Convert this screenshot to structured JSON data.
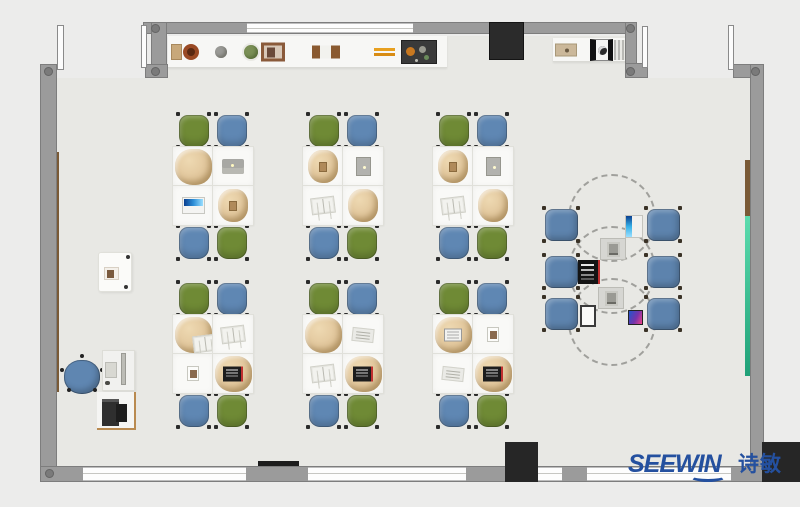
{
  "brand": {
    "name": "SEEWIN",
    "cjk": "诗敏",
    "color": "#24509f"
  },
  "palette": {
    "outside": "#ececeb",
    "floor": "#e8e8e4",
    "wall": "#9b9b9b",
    "chair_green": "#6f8a35",
    "chair_blue": "#5f87b3",
    "discussion_chair_blue": "#5d83ad",
    "schoolbag_tan": "#dfc398",
    "column_black": "#262626",
    "wall_board_green": "#1fa077",
    "wall_panel_brown": "#7a5a36",
    "tv_black": "#2b2b2b"
  },
  "shelf": {
    "left_items": [
      {
        "type": "wood-box",
        "x": 3
      },
      {
        "type": "pot",
        "x": 15
      },
      {
        "type": "sphere",
        "x": 47
      },
      {
        "type": "plant",
        "x": 76
      },
      {
        "type": "frame",
        "x": 93
      },
      {
        "type": "box-row",
        "x": 144
      },
      {
        "type": "pencils",
        "x": 206
      },
      {
        "type": "tray",
        "x": 233
      }
    ],
    "right_items": [
      {
        "type": "tan-device",
        "x": 2
      },
      {
        "type": "camera",
        "x": 37
      },
      {
        "type": "radiator",
        "x": 61
      }
    ]
  },
  "clusters": [
    {
      "id": "row1-col1",
      "x": 173,
      "y": 115,
      "chairs": [
        "green",
        "blue",
        "blue",
        "green"
      ],
      "desks": [
        "bag-big",
        "laptop-gray",
        "laptop-white-blue",
        "bag-items"
      ]
    },
    {
      "id": "row1-col2",
      "x": 303,
      "y": 115,
      "chairs": [
        "green",
        "blue",
        "blue",
        "green"
      ],
      "desks": [
        "bag-items",
        "tablet",
        "book",
        "bag"
      ]
    },
    {
      "id": "row1-col3",
      "x": 433,
      "y": 115,
      "chairs": [
        "green",
        "blue",
        "blue",
        "green"
      ],
      "desks": [
        "bag-items",
        "tablet",
        "book",
        "bag"
      ]
    },
    {
      "id": "row2-col1",
      "x": 173,
      "y": 283,
      "chairs": [
        "green",
        "blue",
        "blue",
        "green"
      ],
      "desks": [
        "bag-book",
        "book",
        "photo",
        "bag-laptop-dark"
      ]
    },
    {
      "id": "row2-col2",
      "x": 303,
      "y": 283,
      "chairs": [
        "green",
        "blue",
        "blue",
        "green"
      ],
      "desks": [
        "bag-big",
        "paper",
        "book",
        "bag-laptop-dark"
      ]
    },
    {
      "id": "row2-col3",
      "x": 433,
      "y": 283,
      "chairs": [
        "green",
        "blue",
        "blue",
        "green"
      ],
      "desks": [
        "bag-laptop-white",
        "photo",
        "paper",
        "bag-laptop-dark"
      ]
    }
  ],
  "discussion": {
    "dashed_tables": [
      {
        "cx": 612,
        "cy": 218,
        "r": 44
      },
      {
        "cx": 612,
        "cy": 270,
        "r": 44
      },
      {
        "cx": 612,
        "cy": 322,
        "r": 44
      }
    ],
    "chairs": [
      {
        "x": 545,
        "y": 209
      },
      {
        "x": 545,
        "y": 256
      },
      {
        "x": 545,
        "y": 298
      },
      {
        "x": 647,
        "y": 209
      },
      {
        "x": 647,
        "y": 256
      },
      {
        "x": 647,
        "y": 298
      }
    ],
    "devices": [
      {
        "type": "monitor-blue",
        "x": 625,
        "y": 215
      },
      {
        "type": "reader",
        "x": 600,
        "y": 238
      },
      {
        "type": "laptop-black",
        "x": 578,
        "y": 260
      },
      {
        "type": "reader",
        "x": 598,
        "y": 287
      },
      {
        "type": "laptop-white",
        "x": 580,
        "y": 305
      },
      {
        "type": "phone",
        "x": 628,
        "y": 310
      }
    ]
  },
  "teacher_area": {
    "elements": [
      "side-cabinet",
      "office-chair",
      "teacher-desk",
      "monitor",
      "keyboard",
      "mouse",
      "printer-table",
      "printer"
    ]
  }
}
